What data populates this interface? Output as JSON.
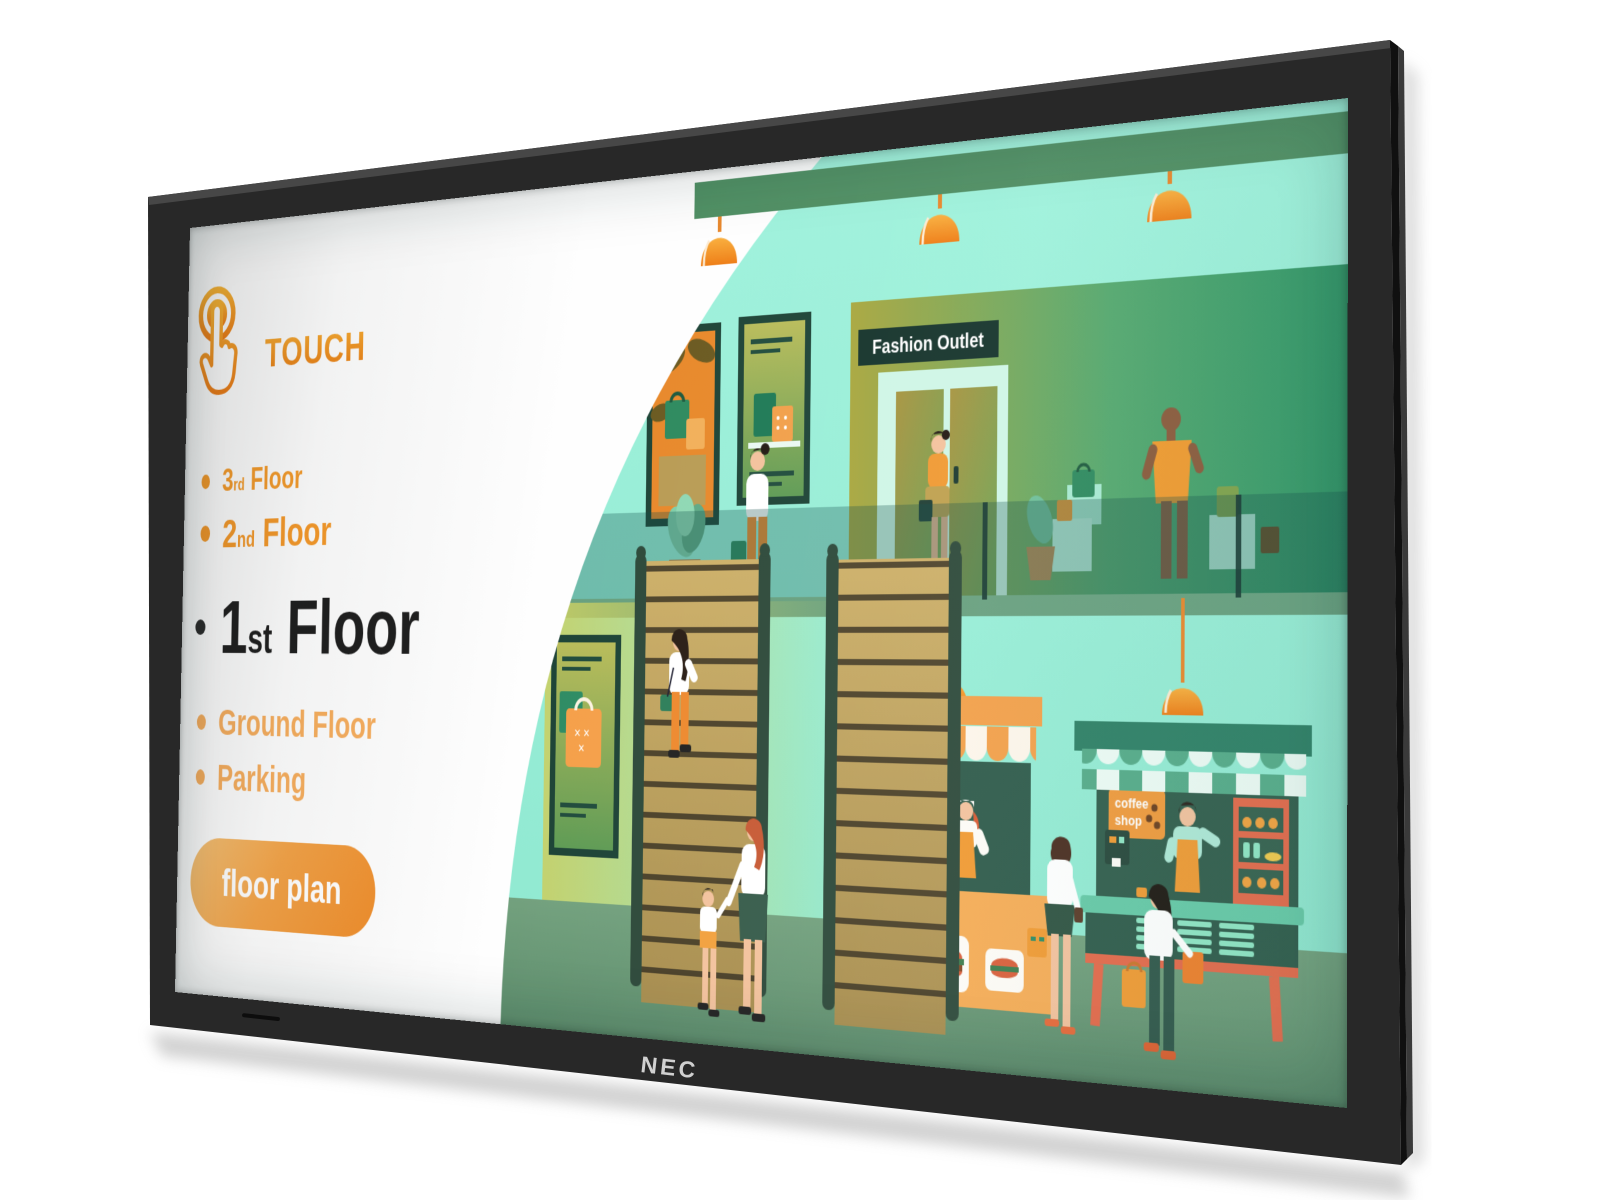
{
  "device": {
    "brand": "NEC"
  },
  "screen": {
    "touch": {
      "label": "TOUCH"
    },
    "floor_menu": {
      "items": [
        {
          "number": "3",
          "suffix": "rd",
          "label": "Floor"
        },
        {
          "number": "2",
          "suffix": "nd",
          "label": "Floor"
        },
        {
          "number": "1",
          "suffix": "st",
          "label": "Floor",
          "selected": true
        },
        {
          "number": "",
          "suffix": "",
          "label": "Ground Floor"
        },
        {
          "number": "",
          "suffix": "",
          "label": "Parking"
        }
      ],
      "button": {
        "label": "floor plan"
      }
    },
    "illustration": {
      "fashion_sign": "Fashion Outlet",
      "menu_sign": "MENU",
      "coffee_sign_line1": "coffee",
      "coffee_sign_line2": "shop"
    },
    "colors": {
      "accent_orange": "#F0941F",
      "mint": "#96ECD5",
      "beam_green": "#4F8F63",
      "floor_green": "#6F9D7B",
      "frame_black": "#282828"
    }
  }
}
